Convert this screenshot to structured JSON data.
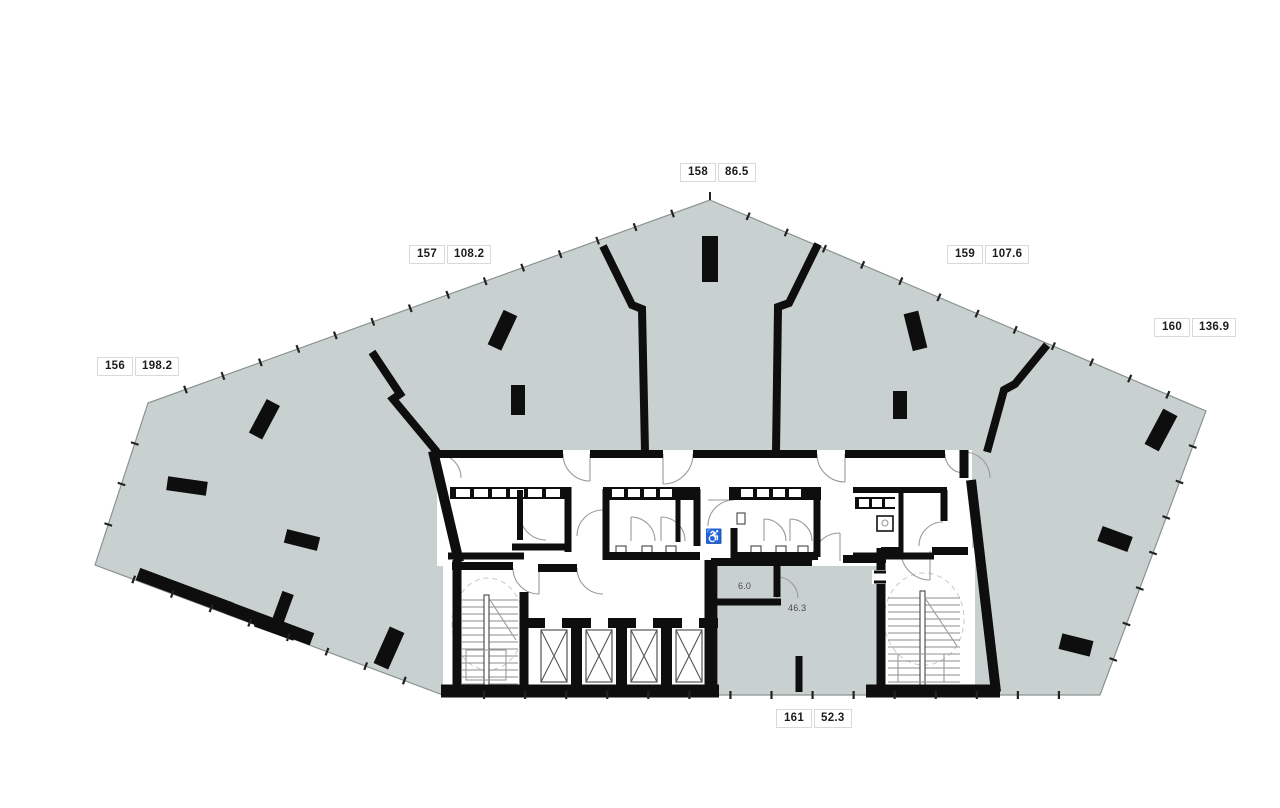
{
  "units": [
    {
      "id": "156",
      "area": "198.2"
    },
    {
      "id": "157",
      "area": "108.2"
    },
    {
      "id": "158",
      "area": "86.5"
    },
    {
      "id": "159",
      "area": "107.6"
    },
    {
      "id": "160",
      "area": "136.9"
    },
    {
      "id": "161",
      "area": "52.3"
    }
  ],
  "inline_labels": {
    "room_6": "6.0",
    "room_46": "46.3"
  },
  "icons": {
    "wheelchair": "♿"
  },
  "colors": {
    "floor_fill": "#c8d1cf",
    "wall": "#0e0e0e",
    "outline": "#8a9390",
    "detail_line": "#9a9a9a",
    "label_border": "#d9d9d9",
    "label_bg": "#ffffff",
    "label_text": "#1c1c1c"
  }
}
